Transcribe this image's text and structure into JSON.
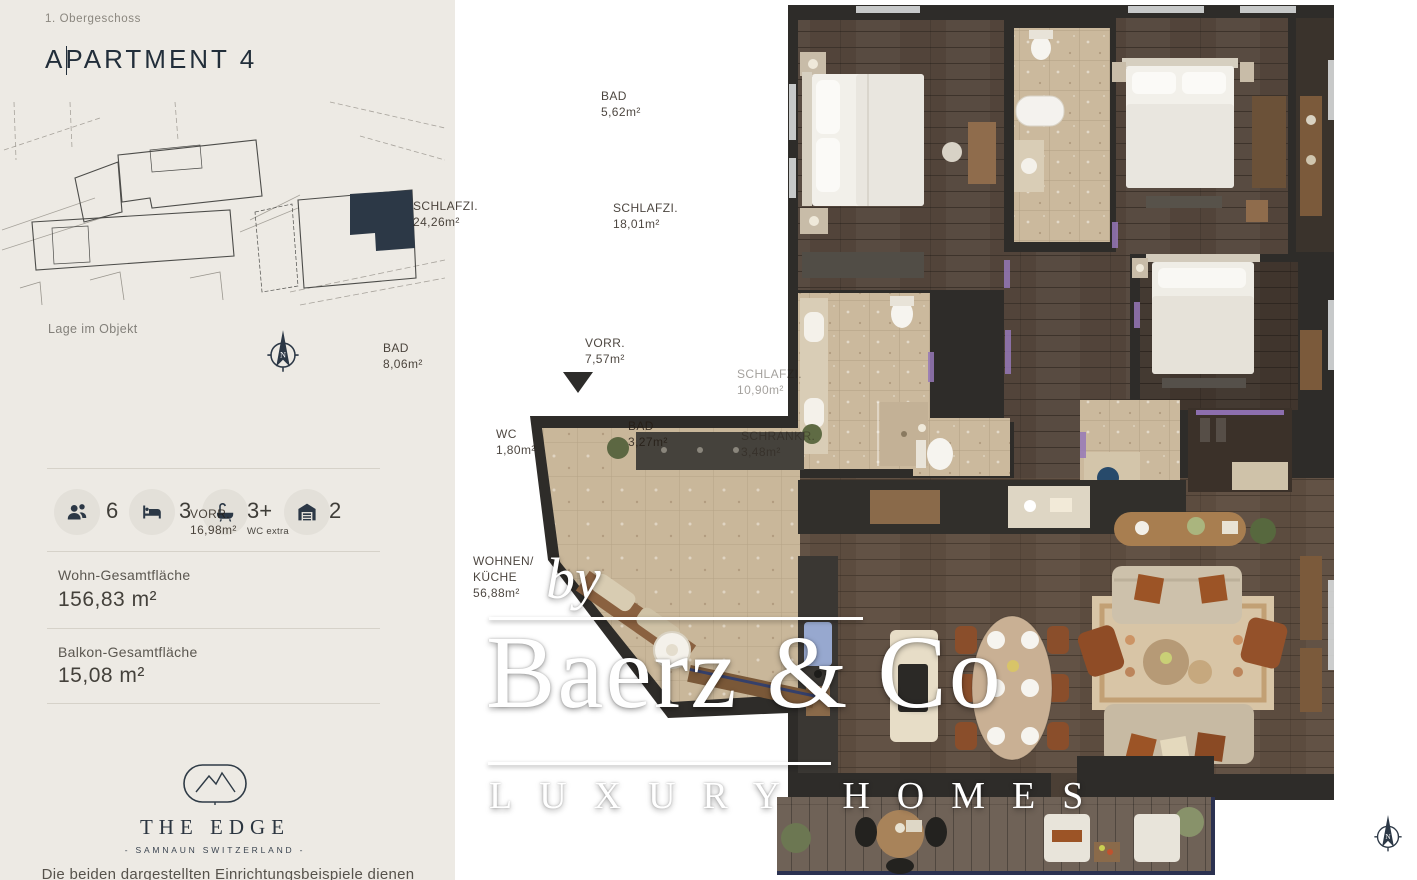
{
  "sidebar": {
    "floor_label": "1. Obergeschoss",
    "title": "APARTMENT 4",
    "site_plan_caption": "Lage im Objekt",
    "stats": [
      {
        "icon": "people-icon",
        "value": "6"
      },
      {
        "icon": "bed-icon",
        "value": "3"
      },
      {
        "icon": "bath-icon",
        "value": "3+",
        "note": "WC extra"
      },
      {
        "icon": "garage-icon",
        "value": "2"
      }
    ],
    "areas": [
      {
        "label": "Wohn-Gesamtfläche",
        "value": "156,83 m²"
      },
      {
        "label": "Balkon-Gesamtfläche",
        "value": "15,08 m²"
      }
    ],
    "logo": {
      "name": "THE EDGE",
      "subtitle": "- SAMNAUN SWITZERLAND -"
    },
    "footer_note": "Die beiden dargestellten Einrichtungsbeispiele dienen lediglich"
  },
  "compass": {
    "letter": "N"
  },
  "watermark": {
    "by": "by",
    "brand": "Baerz & Co",
    "tagline": "LUXURY HOMES"
  },
  "floorplan": {
    "rooms": [
      {
        "name": "SCHLAFZI.",
        "area": "24,26m²"
      },
      {
        "name": "BAD",
        "area": "5,62m²"
      },
      {
        "name": "SCHLAFZI.",
        "area": "18,01m²"
      },
      {
        "name": "VORR.",
        "area": "7,57m²"
      },
      {
        "name": "SCHLAFZI.",
        "area": "10,90m²"
      },
      {
        "name": "BAD",
        "area": "8,06m²"
      },
      {
        "name": "WC",
        "area": "1,80m²"
      },
      {
        "name": "BAD",
        "area": "3,27m²"
      },
      {
        "name": "SCHRANKR.",
        "area": "3,48m²"
      },
      {
        "name": "VORR.",
        "area": "16,98m²"
      },
      {
        "name": "WOHNEN/",
        "name2": "KÜCHE",
        "area": "56,88m²"
      }
    ]
  },
  "colors": {
    "accent_navy": "#2c3846",
    "sidebar_bg": "#edeae4",
    "wall": "#2e2c29",
    "wood_floor": "#52443a",
    "tile_floor": "#cbb99d",
    "deck": "#6f6257",
    "balcony_edge": "#2b3150",
    "door_accent": "#9678b8",
    "watermark": "#ffffff"
  }
}
